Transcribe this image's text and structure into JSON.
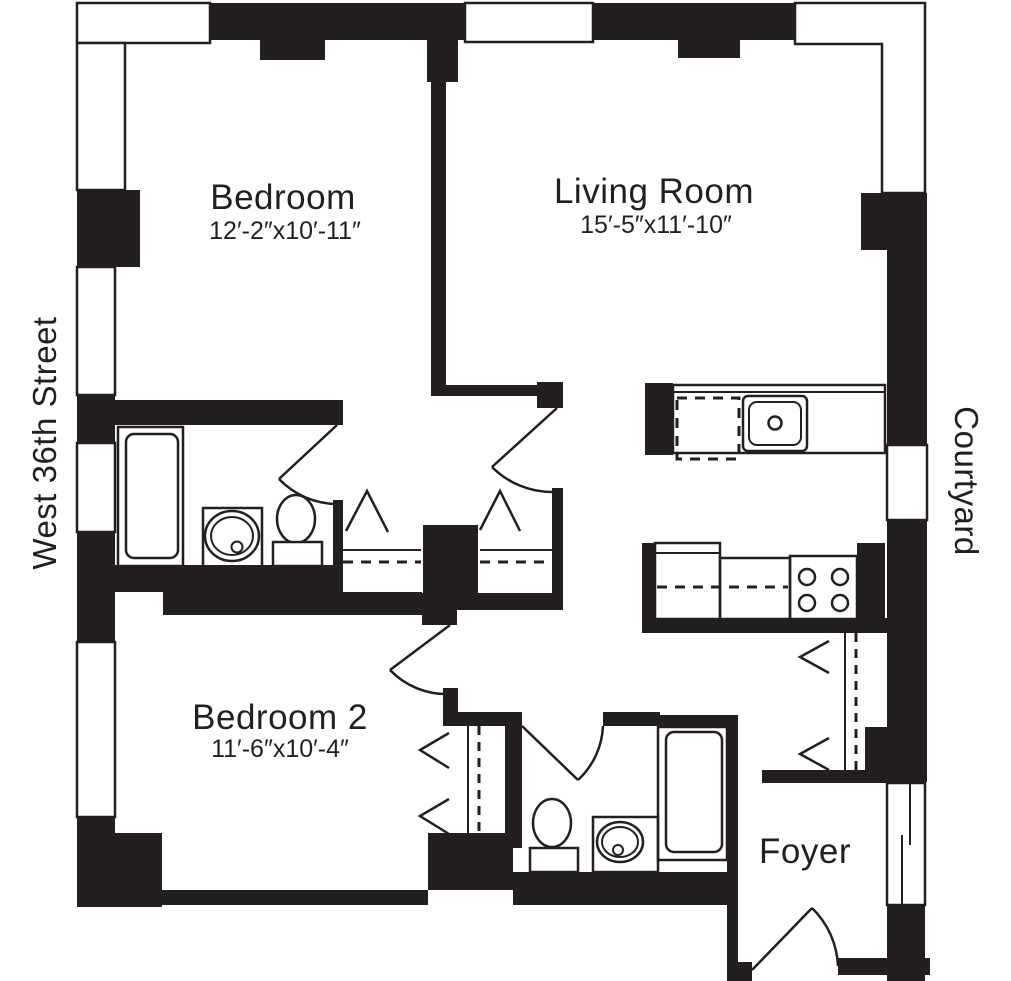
{
  "plan_title": "Two Bedroom Floor Plan",
  "rooms": {
    "bedroom": {
      "name": "Bedroom",
      "dims": "12′-2″x10′-11″"
    },
    "living_room": {
      "name": "Living Room",
      "dims": "15′-5″x11′-10″"
    },
    "bedroom_2": {
      "name": "Bedroom 2",
      "dims": "11′-6″x10′-4″"
    },
    "foyer": {
      "name": "Foyer"
    }
  },
  "surroundings": {
    "west_side": "West 36th Street",
    "east_side": "Courtyard"
  },
  "colors": {
    "wall": "#231f20",
    "background": "#ffffff"
  },
  "fixtures": {
    "bathroom_1": [
      "bathtub",
      "sink-vanity",
      "toilet"
    ],
    "bathroom_2": [
      "bathtub",
      "sink-vanity",
      "toilet"
    ],
    "kitchen": [
      "dishwasher",
      "kitchen-sink",
      "refrigerator",
      "counter",
      "stove-4-burner"
    ],
    "closets": [
      "hall-closet",
      "hall-closet",
      "bedroom-2-closet",
      "foyer-closet"
    ],
    "doors": [
      "bathroom-1-door",
      "hall-door",
      "bedroom-2-door",
      "bathroom-2-door",
      "entry-door"
    ]
  }
}
